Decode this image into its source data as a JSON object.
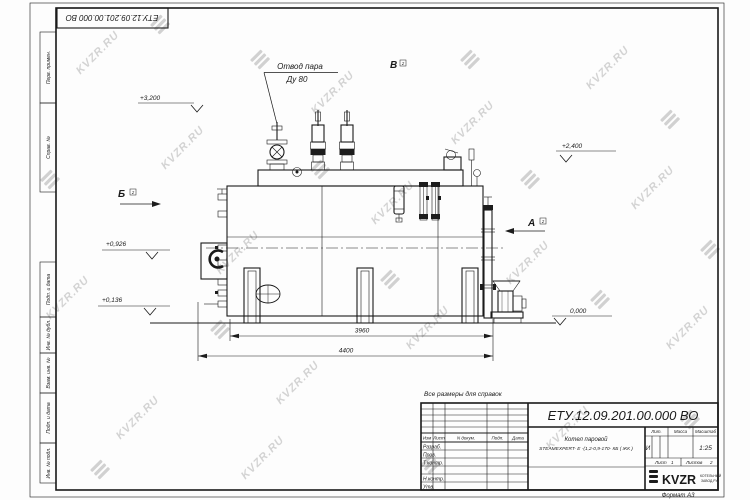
{
  "page": {
    "format_label": "Формат А3",
    "reference_note": "Все размеры для справок",
    "watermark_text": "KVZR.RU"
  },
  "top_stamp": {
    "designation": "ЕТУ.12.09.201.00.000  ВО"
  },
  "margin_stamps": {
    "items": [
      {
        "label": "Перв. примен."
      },
      {
        "label": "Справ. №"
      },
      {
        "label": "Подп. и дата"
      },
      {
        "label": "Инв. № дубл."
      },
      {
        "label": "Взам. инв. №"
      },
      {
        "label": "Подп. и дата"
      },
      {
        "label": "Инв. № подл."
      }
    ]
  },
  "drawing": {
    "callout": {
      "line1": "Отвод пара",
      "line2": "Ду 80"
    },
    "elevations": [
      {
        "value": "+3,200"
      },
      {
        "value": "+2,400"
      },
      {
        "value": "+0,926"
      },
      {
        "value": "+0,136"
      },
      {
        "value": "0,000"
      }
    ],
    "views": [
      {
        "letter": "Б",
        "sheet": "2"
      },
      {
        "letter": "В",
        "sheet": "2"
      },
      {
        "letter": "А",
        "sheet": "2"
      }
    ],
    "dimensions": [
      {
        "value": "3960"
      },
      {
        "value": "4400"
      }
    ]
  },
  "title_block": {
    "designation": "ЕТУ.12.09.201.00.000  ВО",
    "product_line1": "Котел паровой",
    "product_line2": "STEAMEXPERT- E -(1,2-0,9-170- КБ ( ЖК )",
    "header_cols": [
      "Изм",
      "Лист",
      "N докум.",
      "Подп.",
      "Дата"
    ],
    "staff_rows": [
      "Разраб.",
      "Пров.",
      "Т.контр.",
      "",
      "Н.контр.",
      "Утв."
    ],
    "lit_header": "Лит.",
    "mass_header": "Масса",
    "scale_header": "Масштаб",
    "lit_value": "И",
    "scale_value": "1:25",
    "sheet_label": "Лист",
    "sheet_value": "1",
    "sheets_label": "Листов",
    "sheets_value": "2",
    "logo_text": "KVZR",
    "logo_caption1": "КОТЕЛЬНЫЙ",
    "logo_caption2": "ЗАВОД.РУ"
  }
}
